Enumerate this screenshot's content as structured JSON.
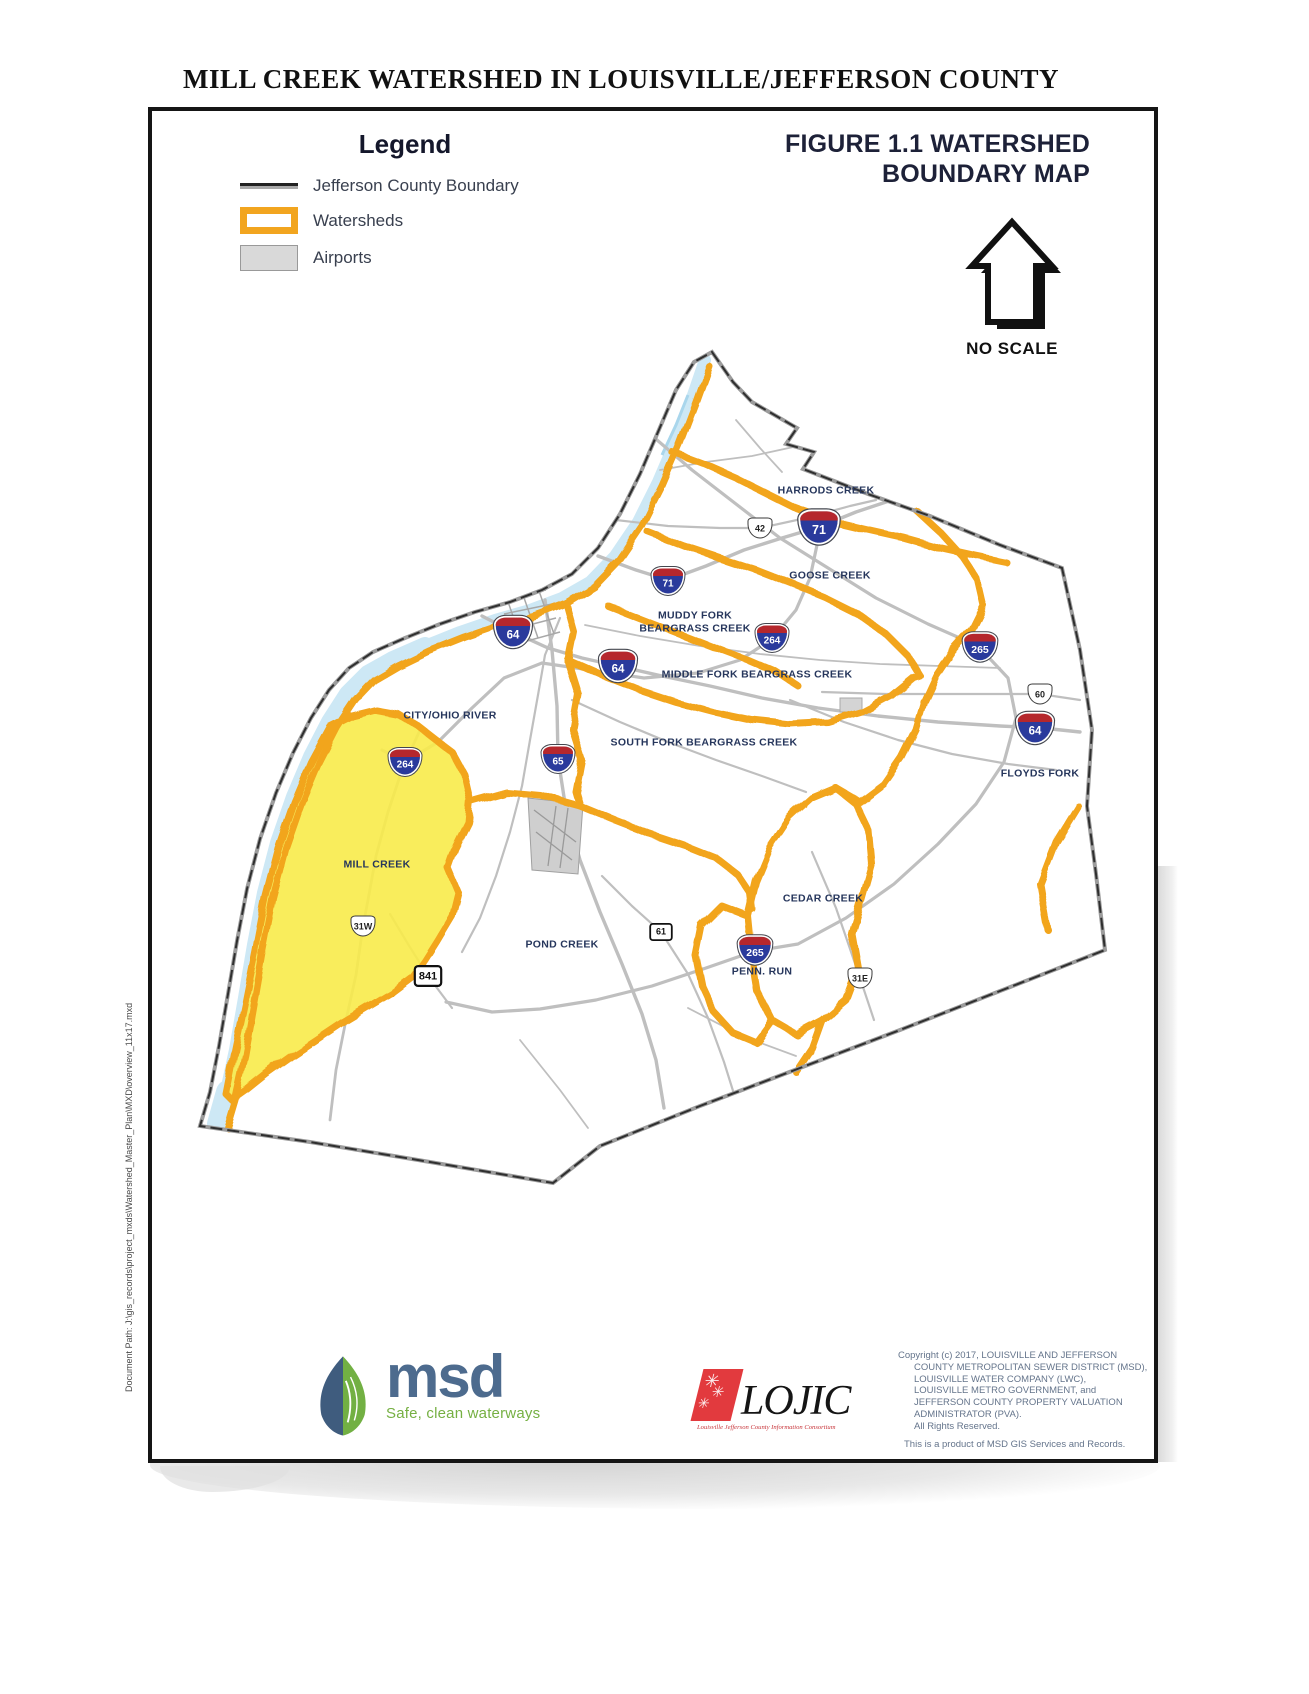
{
  "page": {
    "title": "MILL CREEK WATERSHED IN LOUISVILLE/JEFFERSON COUNTY",
    "document_path": "Document Path: J:\\gis_records\\project_mxds\\Watershed_Master_Plan\\MXD\\overview_11x17.mxd"
  },
  "legend": {
    "title": "Legend",
    "items": [
      {
        "symbol": "county-line",
        "label": "Jefferson County Boundary"
      },
      {
        "symbol": "watershed-outline",
        "label": "Watersheds"
      },
      {
        "symbol": "airport-fill",
        "label": "Airports"
      }
    ]
  },
  "figure": {
    "title_line1": "FIGURE 1.1 WATERSHED",
    "title_line2": "BOUNDARY MAP",
    "scale_note": "NO SCALE"
  },
  "map": {
    "colors": {
      "watershed_orange": "#F2A51F",
      "mill_creek_yellow": "#F8EB4A",
      "river_blue": "#CDE8F5",
      "county_line": "#3b3b3b",
      "road_gray": "#bfbfbf",
      "label_navy": "#26365c"
    },
    "watershed_labels": [
      {
        "text": "HARRODS CREEK",
        "x": 826,
        "y": 491
      },
      {
        "text": "GOOSE CREEK",
        "x": 830,
        "y": 576
      },
      {
        "text": "MUDDY FORK\nBEARGRASS CREEK",
        "x": 695,
        "y": 622
      },
      {
        "text": "MIDDLE FORK BEARGRASS CREEK",
        "x": 757,
        "y": 675
      },
      {
        "text": "SOUTH FORK BEARGRASS CREEK",
        "x": 704,
        "y": 743
      },
      {
        "text": "CITY/OHIO RIVER",
        "x": 450,
        "y": 716
      },
      {
        "text": "FLOYDS FORK",
        "x": 1040,
        "y": 774
      },
      {
        "text": "MILL CREEK",
        "x": 377,
        "y": 865
      },
      {
        "text": "POND CREEK",
        "x": 562,
        "y": 945
      },
      {
        "text": "CEDAR CREEK",
        "x": 823,
        "y": 899
      },
      {
        "text": "PENN. RUN",
        "x": 762,
        "y": 972
      }
    ],
    "shields": [
      {
        "type": "interstate",
        "label": "71",
        "x": 819,
        "y": 527,
        "s": 1.25
      },
      {
        "type": "interstate",
        "label": "71",
        "x": 668,
        "y": 581,
        "s": 1
      },
      {
        "type": "us",
        "label": "42",
        "x": 760,
        "y": 528,
        "s": 1
      },
      {
        "type": "interstate",
        "label": "64",
        "x": 513,
        "y": 632,
        "s": 1.15
      },
      {
        "type": "interstate",
        "label": "64",
        "x": 618,
        "y": 666,
        "s": 1.15
      },
      {
        "type": "interstate",
        "label": "264",
        "x": 772,
        "y": 638,
        "s": 1
      },
      {
        "type": "interstate",
        "label": "265",
        "x": 980,
        "y": 647,
        "s": 1.05
      },
      {
        "type": "us",
        "label": "60",
        "x": 1040,
        "y": 694,
        "s": 1
      },
      {
        "type": "interstate",
        "label": "64",
        "x": 1035,
        "y": 728,
        "s": 1.15
      },
      {
        "type": "interstate",
        "label": "65",
        "x": 558,
        "y": 759,
        "s": 1
      },
      {
        "type": "interstate",
        "label": "264",
        "x": 405,
        "y": 762,
        "s": 1
      },
      {
        "type": "us",
        "label": "31W",
        "x": 363,
        "y": 926,
        "s": 1
      },
      {
        "type": "state",
        "label": "841",
        "x": 428,
        "y": 976,
        "s": 1.1
      },
      {
        "type": "state",
        "label": "61",
        "x": 661,
        "y": 932,
        "s": 0.9
      },
      {
        "type": "interstate",
        "label": "265",
        "x": 755,
        "y": 950,
        "s": 1.05
      },
      {
        "type": "us",
        "label": "31E",
        "x": 860,
        "y": 978,
        "s": 1
      }
    ]
  },
  "logos": {
    "msd": {
      "name": "msd",
      "tagline": "Safe, clean waterways"
    },
    "lojic": {
      "name": "LOJIC",
      "tagline": "Louisville Jefferson County Information Consortium"
    }
  },
  "credits": {
    "lines": [
      {
        "text": "Copyright (c) 2017, LOUISVILLE AND JEFFERSON",
        "indent": false
      },
      {
        "text": "COUNTY METROPOLITAN SEWER DISTRICT (MSD),",
        "indent": true
      },
      {
        "text": "LOUISVILLE WATER COMPANY (LWC),",
        "indent": true
      },
      {
        "text": "LOUISVILLE METRO GOVERNMENT, and",
        "indent": true
      },
      {
        "text": "JEFFERSON COUNTY PROPERTY VALUATION",
        "indent": true
      },
      {
        "text": "ADMINISTRATOR (PVA).",
        "indent": true
      },
      {
        "text": "All Rights Reserved.",
        "indent": true
      },
      {
        "text": "This is a product of MSD GIS Services and Records.",
        "indent": false,
        "gap": true
      }
    ]
  }
}
